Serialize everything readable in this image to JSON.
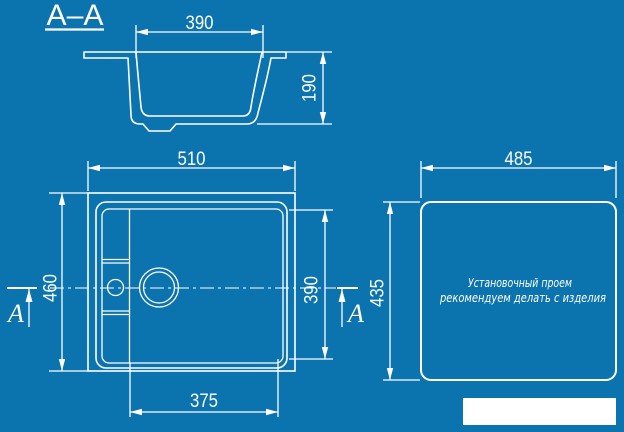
{
  "colors": {
    "background": "#0b73ae",
    "ink": "#ffffff"
  },
  "section_label": "A–A",
  "section_view": {
    "opening_width": "390",
    "depth": "190"
  },
  "plan_view": {
    "overall_width": "510",
    "overall_depth": "460",
    "bowl_depth": "390",
    "bowl_width": "375",
    "section_cut_label": "A"
  },
  "cutout_view": {
    "width": "485",
    "height": "435",
    "note_line1": "Установочный проем",
    "note_line2": "рекомендуем делать с изделия"
  }
}
